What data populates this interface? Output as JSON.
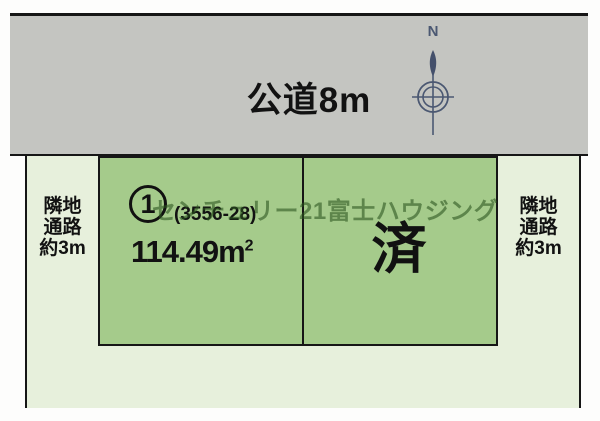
{
  "road": {
    "label": "公道8m",
    "fill_color": "#c4c5c1"
  },
  "compass": {
    "north_label": "N",
    "stroke_color": "#4b5872"
  },
  "passages": {
    "left": {
      "lines": [
        "隣地",
        "通路",
        "約3m"
      ]
    },
    "right": {
      "lines": [
        "隣地",
        "通路",
        "約3m"
      ]
    }
  },
  "plot": {
    "number": "1",
    "parcel_code": "(3556-28)",
    "area_value": "114.49m",
    "area_superscript": "2",
    "status": "済",
    "fill_color": "#a5cb8b"
  },
  "watermark": {
    "text": "センチュリー21富士ハウジング",
    "color": "#2a521e"
  },
  "surround": {
    "fill_color": "#e7f0dc",
    "line_color": "#161616"
  }
}
